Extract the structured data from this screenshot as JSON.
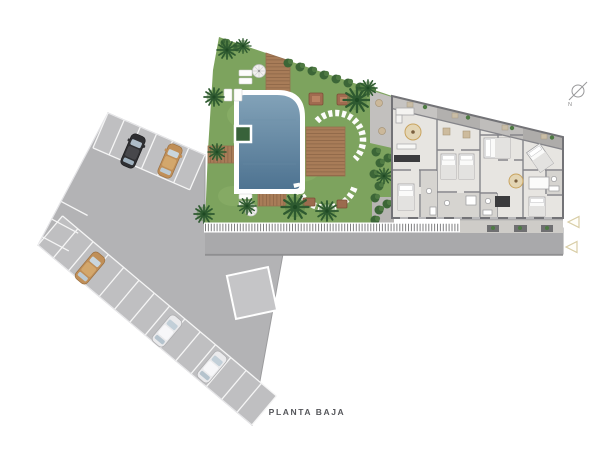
{
  "canvas": {
    "width": 615,
    "height": 454,
    "background": "#ffffff"
  },
  "labels": {
    "plan_title": "PLANTA BAJA",
    "compass_north": "N"
  },
  "palette": {
    "pavement": "#b3b3b5",
    "road": "#a9a9ab",
    "stall_zone": "#bfbfc1",
    "stall_line": "#f5f5f5",
    "grass": "#7da35e",
    "grass_light": "#8cb069",
    "hedge": "#3c6637",
    "palm": "#2e5a30",
    "pool_water_top": "#82a2b8",
    "pool_water_bottom": "#4e7391",
    "pool_border": "#ffffff",
    "deck_wood": "#a87c58",
    "deck_plank_line": "#8d6647",
    "building_floor": "#e7e5e1",
    "building_wall": "#7c7c80",
    "terrace_band": "#bcbab8",
    "bath_floor": "#d6d4d0",
    "rug": "#e3d5b4",
    "kitchen_dark": "#3b3b3d",
    "car_black": "#2f2f32",
    "car_tan": "#c08f58",
    "car_white": "#eaeaec",
    "fence_tick": "#7f7f81",
    "marker_outline": "#d8cda6",
    "compass": "#98989a",
    "title_text": "#55565a"
  },
  "scene": {
    "parking_cars": [
      {
        "color_name": "black",
        "row": "top"
      },
      {
        "color_name": "tan",
        "row": "top"
      },
      {
        "color_name": "tan",
        "row": "bottom"
      },
      {
        "color_name": "white",
        "row": "bottom"
      },
      {
        "color_name": "white",
        "row": "bottom"
      }
    ],
    "garden_features": [
      "swimming-pool",
      "planter-box",
      "wood-decks",
      "boardwalk",
      "sun-loungers",
      "lounger-arcs",
      "palm-trees",
      "parasols"
    ],
    "markers": [
      "triangle-left",
      "triangle-left"
    ]
  }
}
